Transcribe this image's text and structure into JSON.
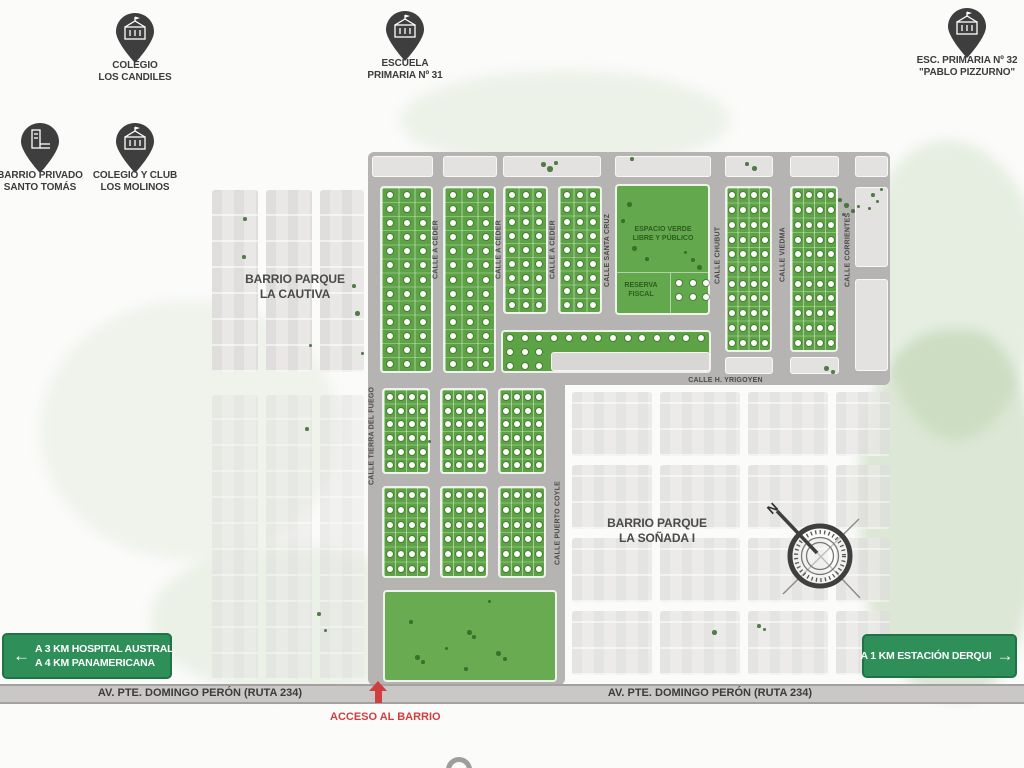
{
  "pins": [
    {
      "line1": "COLEGIO",
      "line2": "LOS CANDILES"
    },
    {
      "line1": "ESCUELA",
      "line2": "PRIMARIA Nº 31"
    },
    {
      "line1": "ESC. PRIMARIA Nº 32",
      "line2": "\"PABLO PIZZURNO\""
    },
    {
      "line1": "BARRIO PRIVADO",
      "line2": "SANTO TOMÁS"
    },
    {
      "line1": "COLEGIO Y CLUB",
      "line2": "LOS MOLINOS"
    }
  ],
  "areas": {
    "cautiva": {
      "line1": "BARRIO PARQUE",
      "line2": "LA CAUTIVA"
    },
    "sonada": {
      "line1": "BARRIO PARQUE",
      "line2": "LA SOÑADA I"
    },
    "espacio_verde": {
      "line1": "ESPACIO VERDE",
      "line2": "LIBRE Y PÚBLICO"
    },
    "reserva": {
      "line1": "RESERVA",
      "line2": "FISCAL"
    }
  },
  "map": {
    "streets": [
      "CALLE A CEDER",
      "CALLE A CEDER",
      "CALLE A CEDER",
      "CALLE SANTA CRUZ",
      "CALLE CHUBUT",
      "CALLE VIEDMA",
      "CALLE CORRIENTES",
      "CALLE H. YRIGOYEN",
      "CALLE TIERRA DEL FUEGO",
      "CALLE PUERTO COYLE"
    ]
  },
  "signs": {
    "hospital": {
      "arrow": "←",
      "line1": "A 3 KM HOSPITAL AUSTRAL",
      "line2": "A 4 KM PANAMERICANA"
    },
    "derqui": {
      "label": "A 1 KM ESTACIÓN DERQUI",
      "arrow": "→"
    }
  },
  "road": {
    "label": "AV. PTE. DOMINGO PERÓN (RUTA 234)"
  },
  "access": {
    "label": "ACCESO AL BARRIO"
  },
  "compass": {
    "north": "N"
  },
  "colors": {
    "sign_green": "#2e8f58",
    "lot_green": "#5da345",
    "park_green": "#63a84c",
    "map_gray": "#b5b4b2",
    "road_gray": "#c9c8c6",
    "pin_dark": "#3e3e3e",
    "access_red": "#cf3f3f"
  }
}
